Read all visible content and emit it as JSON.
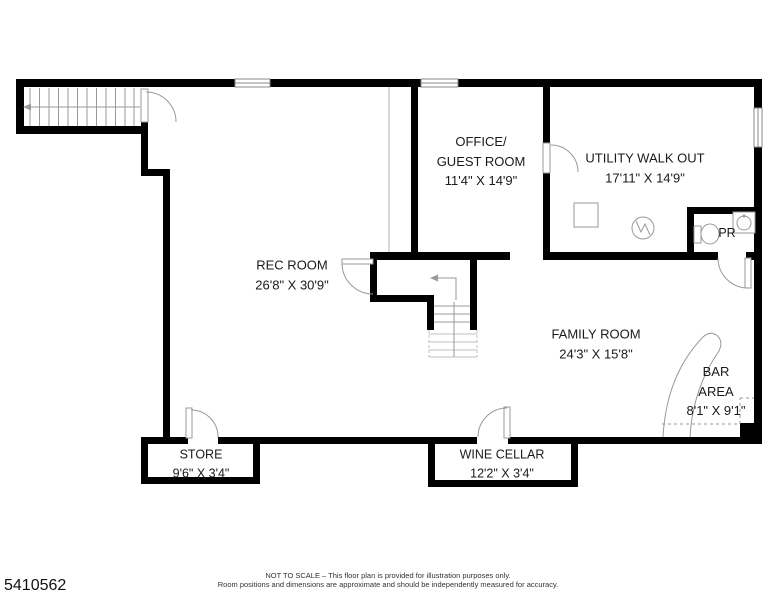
{
  "floor_plan": {
    "mls_number": "5410562",
    "rooms": [
      {
        "id": "office",
        "name": "OFFICE/\nGUEST ROOM",
        "dims": "11'4\" X 14'9\""
      },
      {
        "id": "utility",
        "name": "UTILITY WALK OUT",
        "dims": "17'11\" X 14'9\""
      },
      {
        "id": "pr",
        "name": "PR",
        "dims": ""
      },
      {
        "id": "rec",
        "name": "REC ROOM",
        "dims": "26'8\" X 30'9\""
      },
      {
        "id": "family",
        "name": "FAMILY ROOM",
        "dims": "24'3\" X 15'8\""
      },
      {
        "id": "bar",
        "name": "BAR AREA",
        "dims": "8'1\" X 9'1\""
      },
      {
        "id": "store",
        "name": "STORE",
        "dims": "9'6\" X 3'4\""
      },
      {
        "id": "wine",
        "name": "WINE CELLAR",
        "dims": "12'2\" X 3'4\""
      }
    ],
    "disclaimer_line1": "NOT TO SCALE – This floor plan is provided for illustration purposes only.",
    "disclaimer_line2": "Room positions and dimensions are approximate and should be independently measured for accuracy.",
    "colors": {
      "wall": "#000000",
      "fixture_line": "#999999",
      "light_line": "#c0c0c0",
      "background": "#ffffff"
    }
  }
}
